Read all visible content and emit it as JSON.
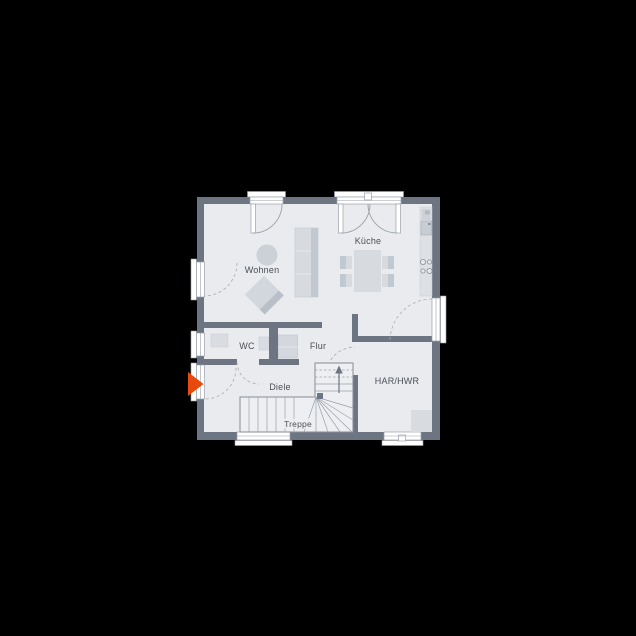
{
  "scene": {
    "type": "architectural-floor-plan",
    "background": "#000000"
  },
  "floorplan": {
    "rooms": {
      "living": "Wohnen",
      "kitchen": "Küche",
      "wc": "WC",
      "hallway": "Flur",
      "foyer": "Diele",
      "stairs": "Treppe",
      "utility": "HAR/HWR"
    },
    "markers": {
      "entrance_arrow": "entrance-direction-marker",
      "stairs_arrow": "stairs-up-direction"
    },
    "colors": {
      "background": "#000000",
      "wall": "#6e7582",
      "floor": "#e9ebee",
      "stair_floor": "#edeff2",
      "furniture": "#d7dbe0",
      "furniture_dark": "#c2c8cf",
      "line": "#9aa0aa",
      "text": "#4b5057",
      "window": "#ffffff",
      "entrance_arrow": "#e84a0e"
    }
  }
}
